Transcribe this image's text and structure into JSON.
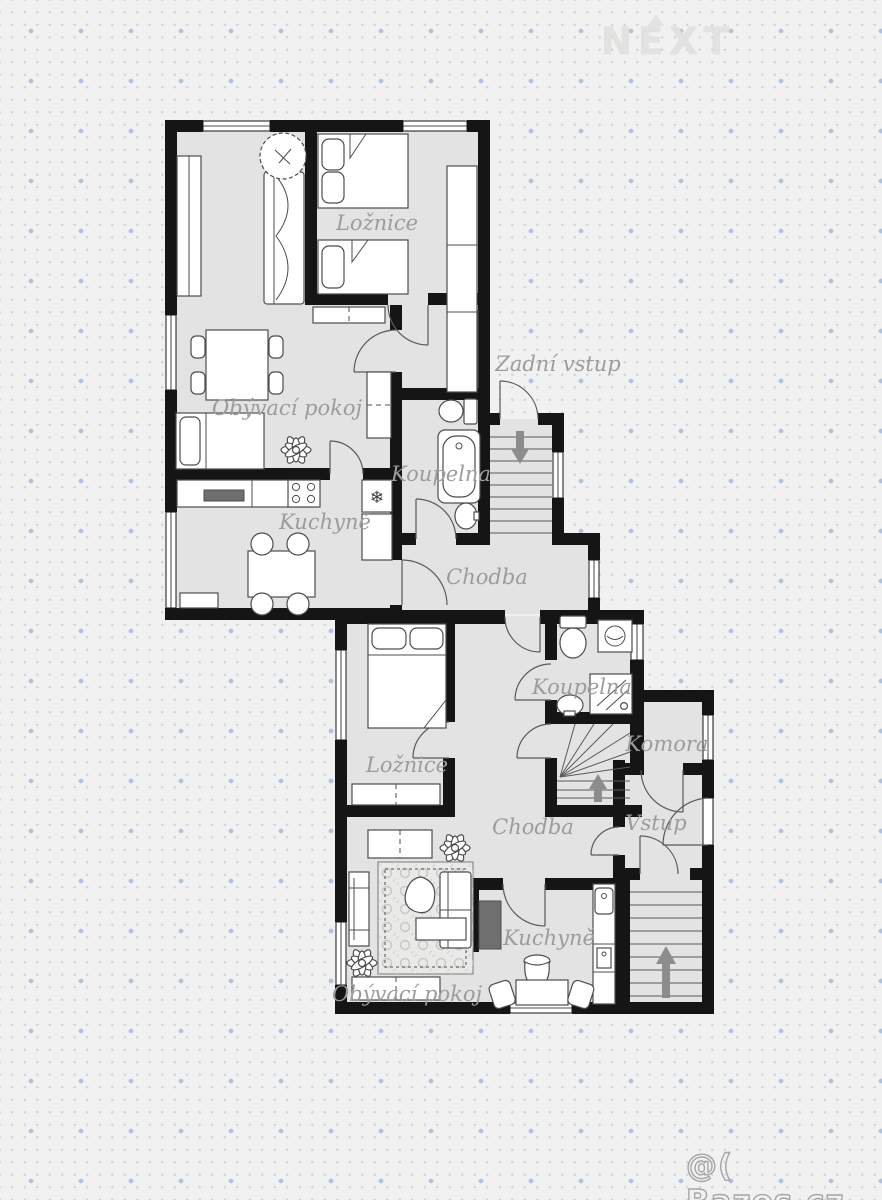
{
  "watermarks": {
    "brand": "NEXT",
    "classifieds": "@( Bazos.cz"
  },
  "palette": {
    "background": "#f0f1f0",
    "floor": "#e2e3e2",
    "wall": "#151515",
    "room_label": "#9c9c9c",
    "dot_small": "#ced3d9",
    "dot_large": "#b3c2dc",
    "stair_arrow": "#8c8c8c"
  },
  "rooms": {
    "upper_bedroom": "Ložnice",
    "upper_living": "Obývací pokoj",
    "upper_kitchen": "Kuchyně",
    "upper_bathroom": "Koupelna",
    "upper_hall": "Chodba",
    "back_entrance": "Zadní vstup",
    "lower_bedroom": "Ložnice",
    "lower_bathroom": "Koupelna",
    "pantry": "Komora",
    "lower_hall": "Chodba",
    "entrance": "Vstup",
    "lower_kitchen": "Kuchyně",
    "lower_living": "Obývací pokoj"
  },
  "symbols": {
    "fridge": "❄"
  }
}
